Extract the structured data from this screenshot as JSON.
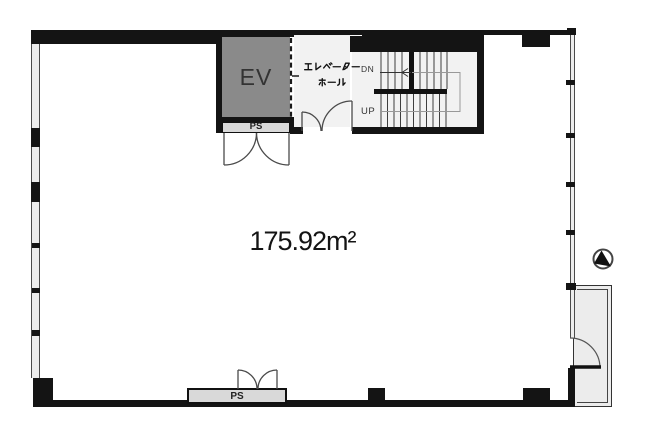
{
  "plan_title": "floor-plan",
  "area": {
    "display": "175.92m²",
    "value": "175.92",
    "unit": "m²"
  },
  "elevator": {
    "label": "EV"
  },
  "elevator_hall": {
    "label": "エレベーターホール",
    "line1": "エレベーター",
    "line2": "ホール"
  },
  "stairs": {
    "down_label": "DN",
    "up_label": "UP"
  },
  "pipe_shaft_top": {
    "label": "PS"
  },
  "pipe_shaft_bottom": {
    "label": "PS"
  },
  "north_arrow": {
    "name": "north-arrow"
  },
  "colors": {
    "wall": "#141414",
    "elevator_fill": "#8a8a8a",
    "room_fill": "#f2f2f2",
    "shaft_fill": "#d9d9d9",
    "bay_fill": "#ececec",
    "line": "#4a4a4a"
  }
}
